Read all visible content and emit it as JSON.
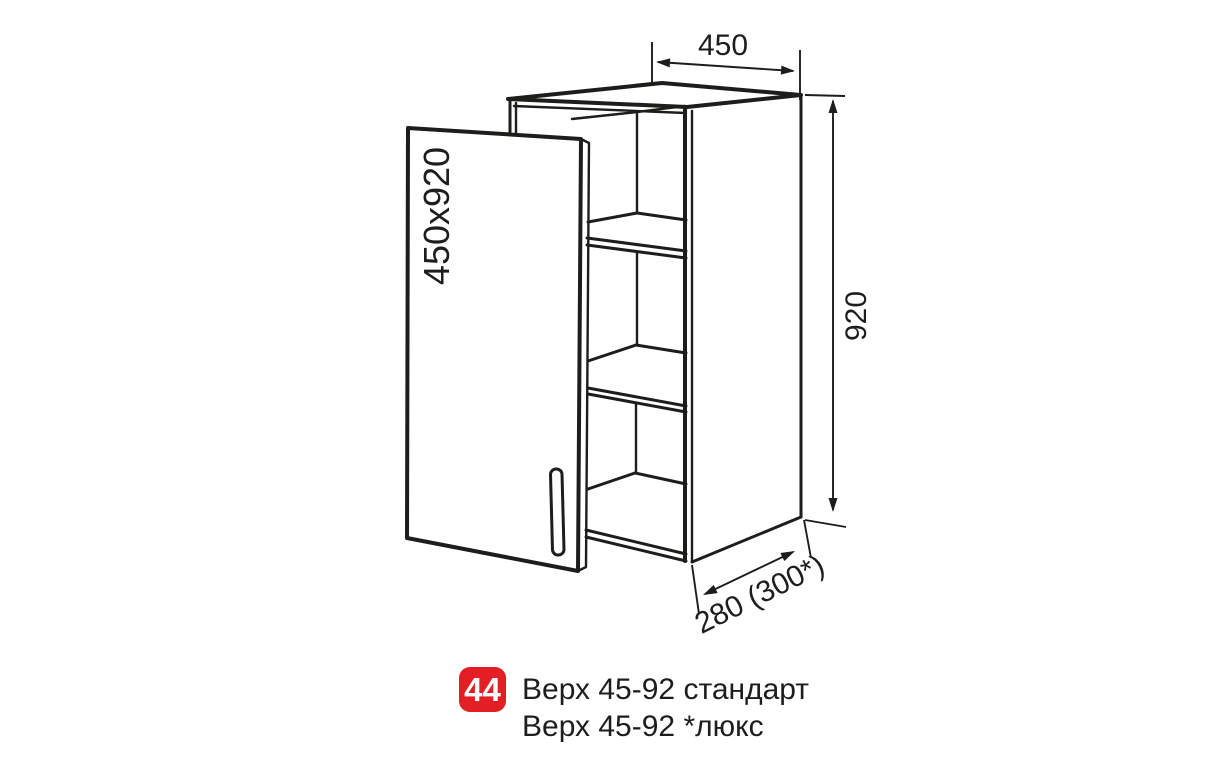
{
  "diagram": {
    "door_label": "450x920",
    "dim_width": "450",
    "dim_height": "920",
    "dim_depth": "280 (300*)"
  },
  "caption": {
    "number": "44",
    "line1": "Верх 45-92 стандарт",
    "line2": "Верх 45-92 *люкс"
  },
  "colors": {
    "line": "#1d1d1b",
    "badge_bg": "#e31e24",
    "badge_text": "#ffffff",
    "background": "#ffffff"
  }
}
